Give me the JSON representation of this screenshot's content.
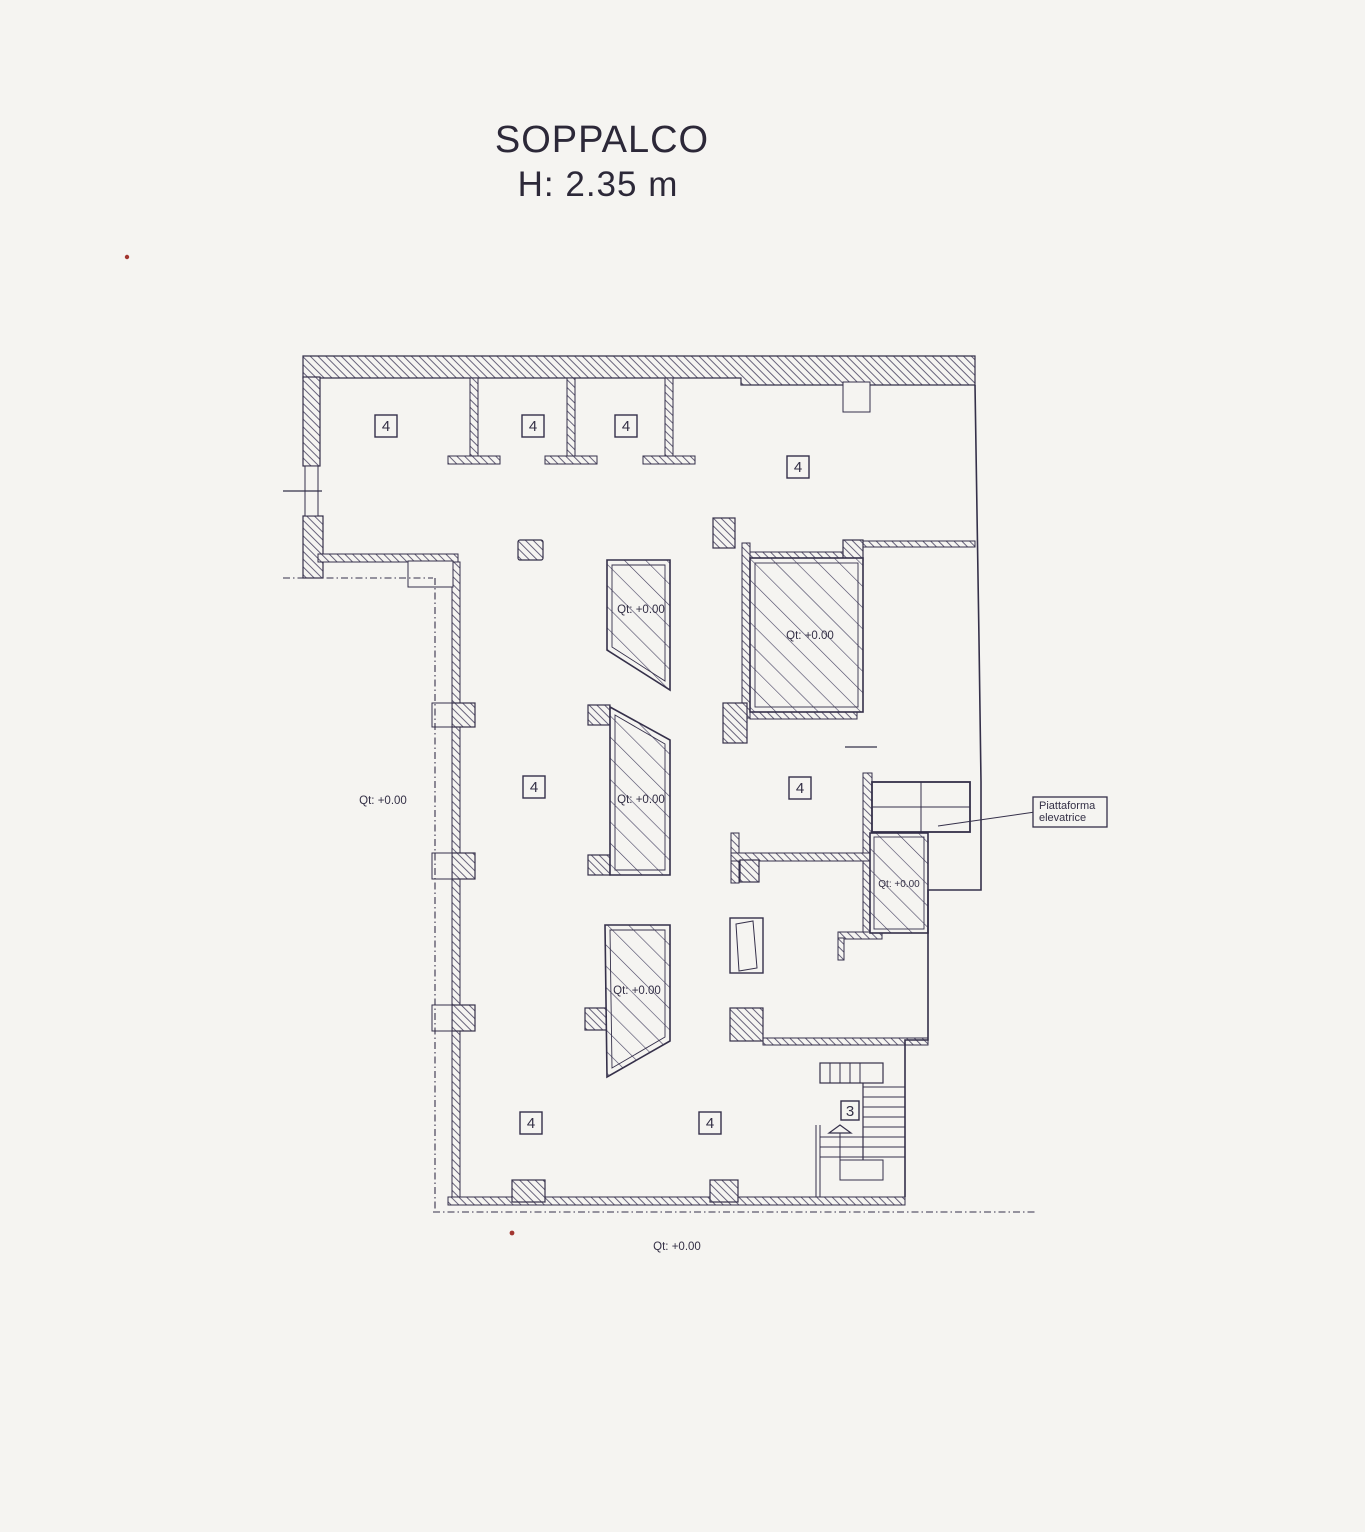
{
  "title": {
    "line1": "SOPPALCO",
    "line2": "H: 2.35 m"
  },
  "labels": {
    "room4": "4",
    "stair": "3",
    "level": "Qt: +0.00",
    "platform_line1": "Piattaforma",
    "platform_line2": "elevatrice"
  },
  "colors": {
    "paper": "#f5f4f1",
    "ink": "#3b3650",
    "wall_hatch": "#57526d",
    "floor_hatch": "#454060",
    "accent_red": "#a23630"
  }
}
